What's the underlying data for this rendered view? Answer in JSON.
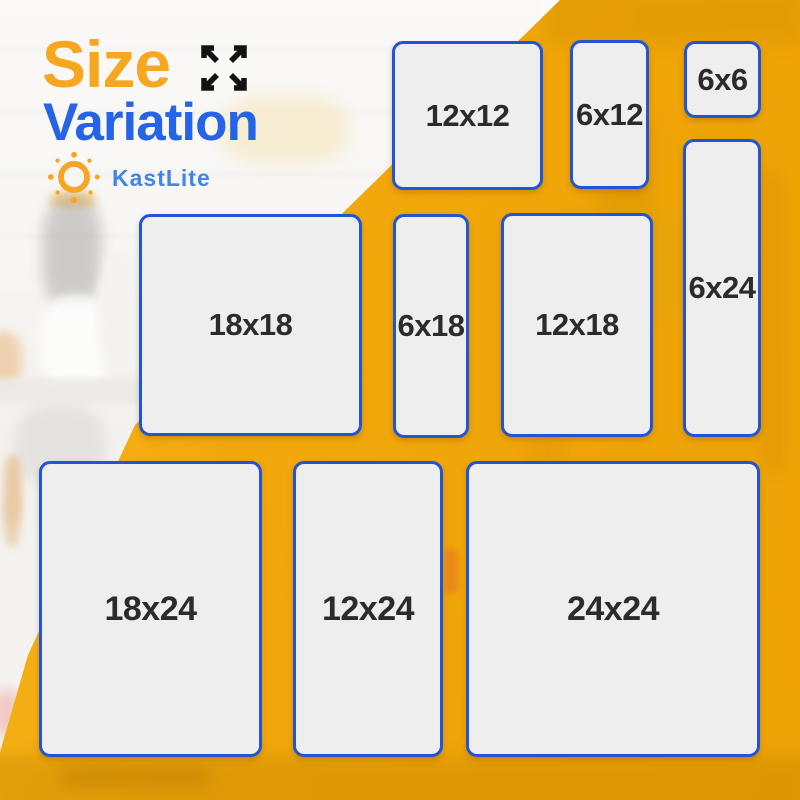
{
  "title": {
    "word1": "Size",
    "word2": "Variation"
  },
  "brand": {
    "name": "KastLite",
    "logo_icon": "sun-icon"
  },
  "header_icon": "expand-arrows-icon",
  "colors": {
    "background_yellow": "#F2A80C",
    "title_orange": "#F5A71F",
    "title_blue": "#2563E7",
    "brand_blue": "#3F86E5",
    "card_border_blue": "#2154D6",
    "card_fill": "#EEEEEF",
    "label_text": "#2B2B2B"
  },
  "sizes": [
    {
      "label": "12x12",
      "x": 392,
      "y": 41,
      "w": 151,
      "h": 149
    },
    {
      "label": "6x12",
      "x": 570,
      "y": 40,
      "w": 79,
      "h": 149
    },
    {
      "label": "6x6",
      "x": 684,
      "y": 41,
      "w": 77,
      "h": 77
    },
    {
      "label": "6x24",
      "x": 683,
      "y": 139,
      "w": 78,
      "h": 298
    },
    {
      "label": "18x18",
      "x": 139,
      "y": 214,
      "w": 223,
      "h": 222
    },
    {
      "label": "6x18",
      "x": 393,
      "y": 214,
      "w": 76,
      "h": 224
    },
    {
      "label": "12x18",
      "x": 501,
      "y": 213,
      "w": 152,
      "h": 224
    },
    {
      "label": "18x24",
      "x": 39,
      "y": 461,
      "w": 223,
      "h": 296
    },
    {
      "label": "12x24",
      "x": 293,
      "y": 461,
      "w": 150,
      "h": 296
    },
    {
      "label": "24x24",
      "x": 466,
      "y": 461,
      "w": 294,
      "h": 296
    }
  ]
}
